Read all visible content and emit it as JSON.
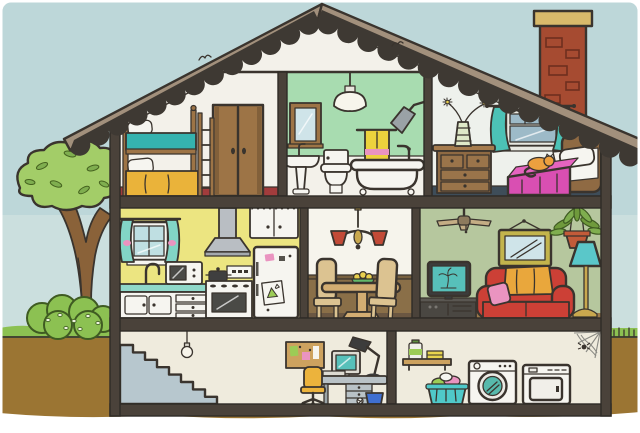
{
  "meta": {
    "type": "illustration",
    "style": "cartoon cutaway (dollhouse) drawing",
    "description": "Cartoon cutaway cross-section of a two-storey house with attic bedrooms, bathroom, kitchen, dining room, living room and a basement with office nook and laundry; tree and bush outside on the left, brick chimney on the roof."
  },
  "scene": {
    "rooms": [
      {
        "id": "bunk-bedroom",
        "name": "Kids' bunk bedroom (attic, left)",
        "items": [
          "wooden bunk bed",
          "white pillows",
          "teal top-bunk blanket",
          "yellow bottom-bunk blanket",
          "ladder",
          "double closet doors",
          "dark red floor"
        ]
      },
      {
        "id": "bathroom",
        "name": "Bathroom (attic, middle)",
        "items": [
          "ceiling pendant lamp",
          "mirror cabinet",
          "pedestal sink",
          "toilet",
          "yellow towel on rail",
          "claw-foot bathtub",
          "wall shower head",
          "green upper wall"
        ]
      },
      {
        "id": "bedroom",
        "name": "Bedroom (attic, right)",
        "items": [
          "chest of drawers",
          "striped vase with flowers",
          "window with teal curtains",
          "bed with pink bedspread",
          "white pillow",
          "wooden headboard",
          "sleeping orange cat"
        ]
      },
      {
        "id": "kitchen",
        "name": "Kitchen (main floor, left)",
        "items": [
          "window with teal curtains",
          "gooseneck faucet",
          "teal countertop",
          "cupboards and drawers",
          "microwave",
          "extractor hood",
          "stove with pot",
          "oven",
          "refrigerator with magnets and child's drawing",
          "upper cabinet"
        ]
      },
      {
        "id": "dining-room",
        "name": "Dining room (main floor, middle)",
        "items": [
          "chandelier with red shades",
          "round pedestal table",
          "bowl of fruit",
          "two high-back chairs",
          "brown wainscoting"
        ]
      },
      {
        "id": "living-room",
        "name": "Living room (main floor, right)",
        "items": [
          "ceiling fan",
          "framed wall mirror",
          "hanging plant",
          "TV showing palm tree",
          "media cabinet",
          "red sofa",
          "orange throw blanket",
          "pink cushion",
          "teal floor lamp"
        ]
      },
      {
        "id": "basement-office",
        "name": "Basement (left) - stairs and desk nook",
        "items": [
          "staircase",
          "bare hanging bulb",
          "pin board with notes",
          "computer monitor",
          "keyboard",
          "desk lamp",
          "drawer desk",
          "yellow swivel chair",
          "blue waste bin",
          "crumpled paper"
        ]
      },
      {
        "id": "laundry-room",
        "name": "Basement (right) - laundry corner",
        "items": [
          "wall shelf",
          "detergent bottle",
          "yellow soapbox",
          "teal laundry basket with clothes",
          "front-loading washer",
          "dryer",
          "spider web with spider"
        ]
      }
    ],
    "outdoor": {
      "sky": "pale blue sky",
      "tree": "leafy green tree",
      "bush": "round shrub with berries",
      "lawn": "green grass strip",
      "soil": "brown earth cross-section",
      "roof": "taupe gable roof with scalloped dark shingle edge",
      "chimney": "red brick chimney with stone cap",
      "birds": "two tiny birds near the roofline"
    }
  },
  "colors": {
    "sky": "#bdd7d9",
    "wash": "#e4eee8",
    "earth": "#9b7533",
    "grass": "#8cc152",
    "foliage": "#a3cd68",
    "trunk": "#8a6239",
    "roof": "#a2907c",
    "shingle": "#3e3933",
    "structure": "#4a423a",
    "brick": "#a64b31",
    "brick_cap": "#d9ba6b",
    "attic_wall": "#f3f1ea",
    "bathroom_wall": "#a8dcb0",
    "bedroom_wall": "#eef1ec",
    "kitchen_wall": "#ece581",
    "dining_wall": "#f6f4ec",
    "living_wall": "#b6c79e",
    "basement_wall": "#efebdd",
    "wainscot": "#8a6f48",
    "bunk_floor": "#a23c3c",
    "bedroom_floor": "#3e4d59",
    "wood": "#9d7446",
    "counter": "#8fd8c9",
    "mattress": "#35b3af",
    "blanket_yellow": "#eab33a",
    "bed_pink": "#d94fb2",
    "couch_red": "#cc4036",
    "throw_orange": "#e9a73c",
    "cushion_pink": "#ea94c0",
    "curtain_teal": "#4cc2b6",
    "lamp_teal": "#5ac7c9",
    "screen_teal": "#57c0ba",
    "stairs": "#b7c7ce",
    "chair_yellow": "#ecb33c",
    "bin_blue": "#3f6fd1",
    "basket_teal": "#4fc9c9",
    "cat_orange": "#eca03f",
    "towel_yellow": "#ecd23d",
    "metal": "#b9bec3",
    "brass": "#c9a84e",
    "shade_red": "#c24a37",
    "mirror_frame": "#c3b44c",
    "glass": "#cfe4e9",
    "window_slate": "#9dbac8",
    "board_tan": "#cda25f",
    "note_green": "#9ccc56",
    "bowl_green": "#63b96a",
    "fruit_yellow": "#e8cf4e",
    "pot_clay": "#c35b39",
    "white": "#f6f5f0"
  }
}
